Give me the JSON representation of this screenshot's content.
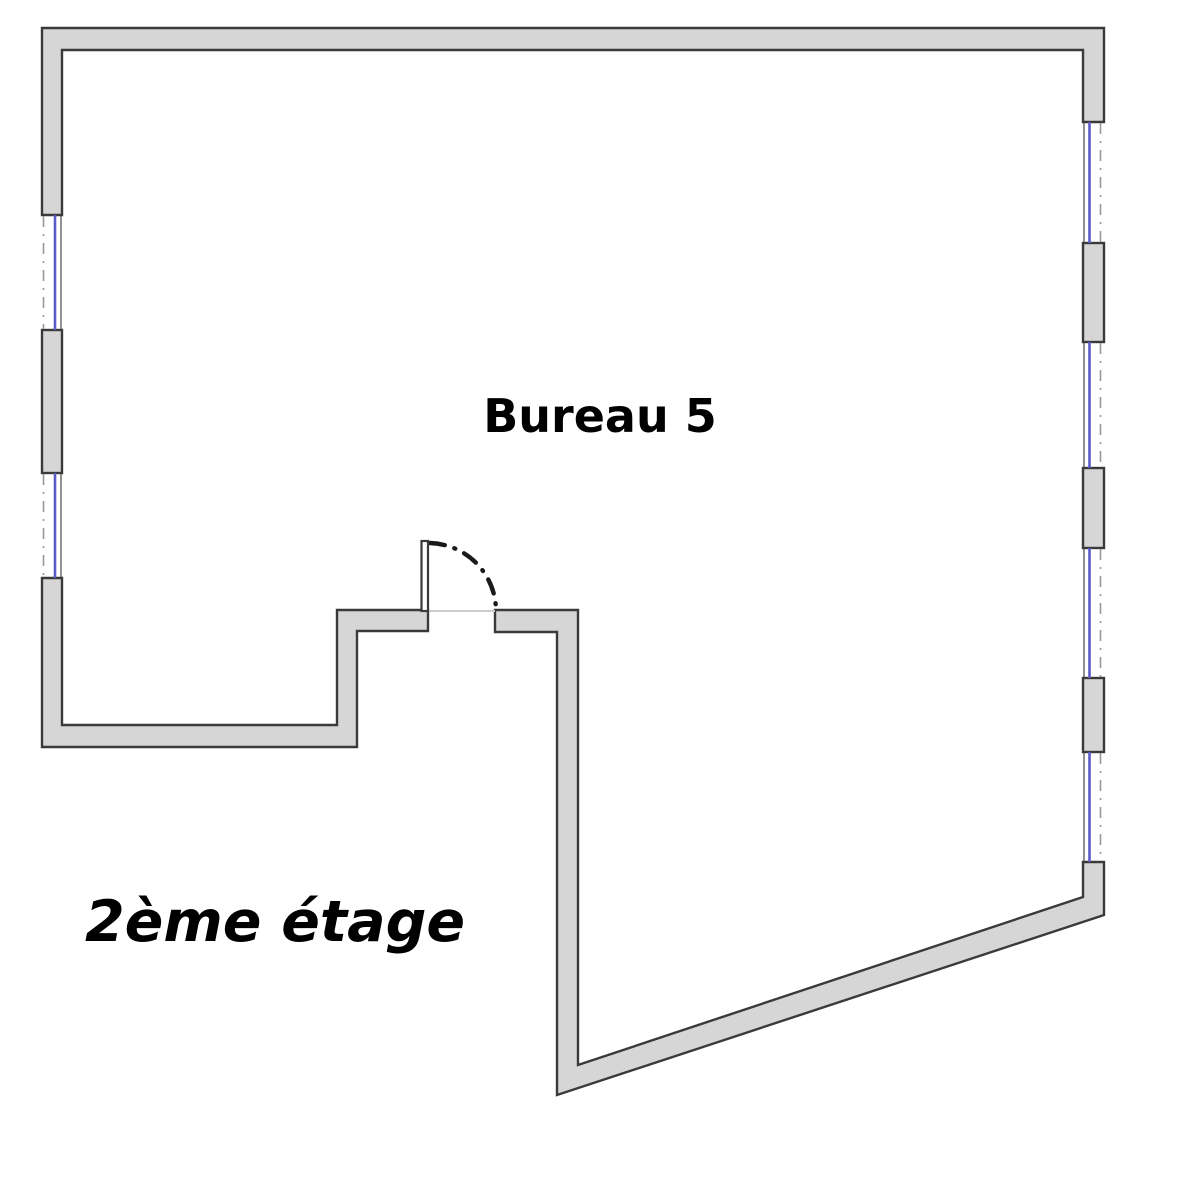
{
  "page": {
    "width": 1177,
    "height": 1200,
    "background": "#ffffff"
  },
  "plan": {
    "room_label": "Bureau 5",
    "floor_label": "2ème étage",
    "colors": {
      "wall_fill": "#d6d6d6",
      "wall_outline": "#3a3a3a",
      "window_glass": "#5a5ac8",
      "window_dash": "#999999",
      "threshold": "#cccccc",
      "label_color": "#000000"
    },
    "windows": {
      "left_wall_count": 2,
      "right_wall_count": 4
    },
    "doors": {
      "count": 1
    }
  }
}
